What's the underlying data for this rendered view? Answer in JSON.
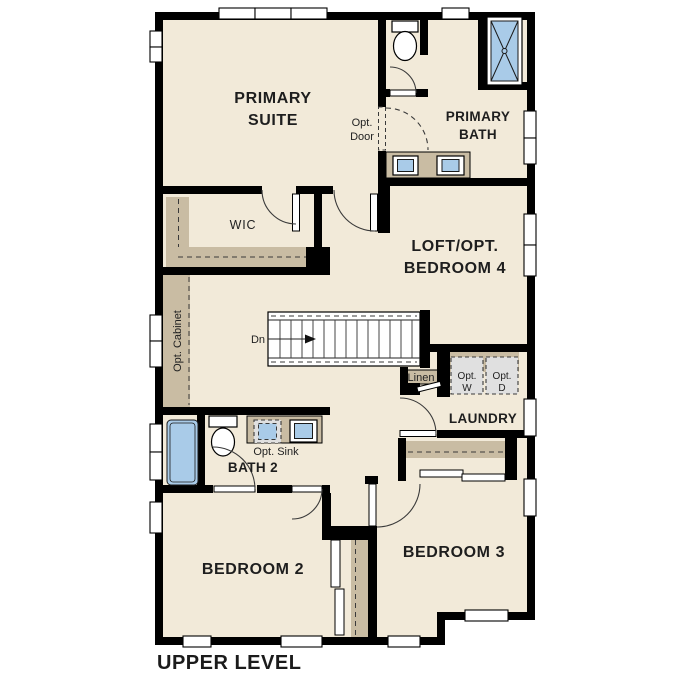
{
  "page_title": "UPPER LEVEL",
  "colors": {
    "wall": "#000000",
    "floor": "#f2ead9",
    "accent_tan": "#c9bca3",
    "fixture_blue": "#a9cbe8",
    "appliance_gray": "#e0e0e0",
    "text": "#1e1e1e"
  },
  "rooms": {
    "primary_suite": {
      "line1": "PRIMARY",
      "line2": "SUITE"
    },
    "primary_bath": {
      "line1": "PRIMARY",
      "line2": "BATH"
    },
    "wic": {
      "label": "WIC"
    },
    "loft_bedroom4": {
      "line1": "LOFT/OPT.",
      "line2": "BEDROOM 4"
    },
    "laundry": {
      "label": "LAUNDRY"
    },
    "bath2": {
      "label": "BATH 2"
    },
    "bedroom2": {
      "label": "BEDROOM 2"
    },
    "bedroom3": {
      "label": "BEDROOM 3"
    }
  },
  "annotations": {
    "opt_door": {
      "line1": "Opt.",
      "line2": "Door"
    },
    "opt_cabinet": "Opt. Cabinet",
    "opt_sink": "Opt. Sink",
    "linen": "Linen",
    "opt_washer": {
      "line1": "Opt.",
      "line2": "W"
    },
    "opt_dryer": {
      "line1": "Opt.",
      "line2": "D"
    },
    "stairs_down": "Dn"
  }
}
